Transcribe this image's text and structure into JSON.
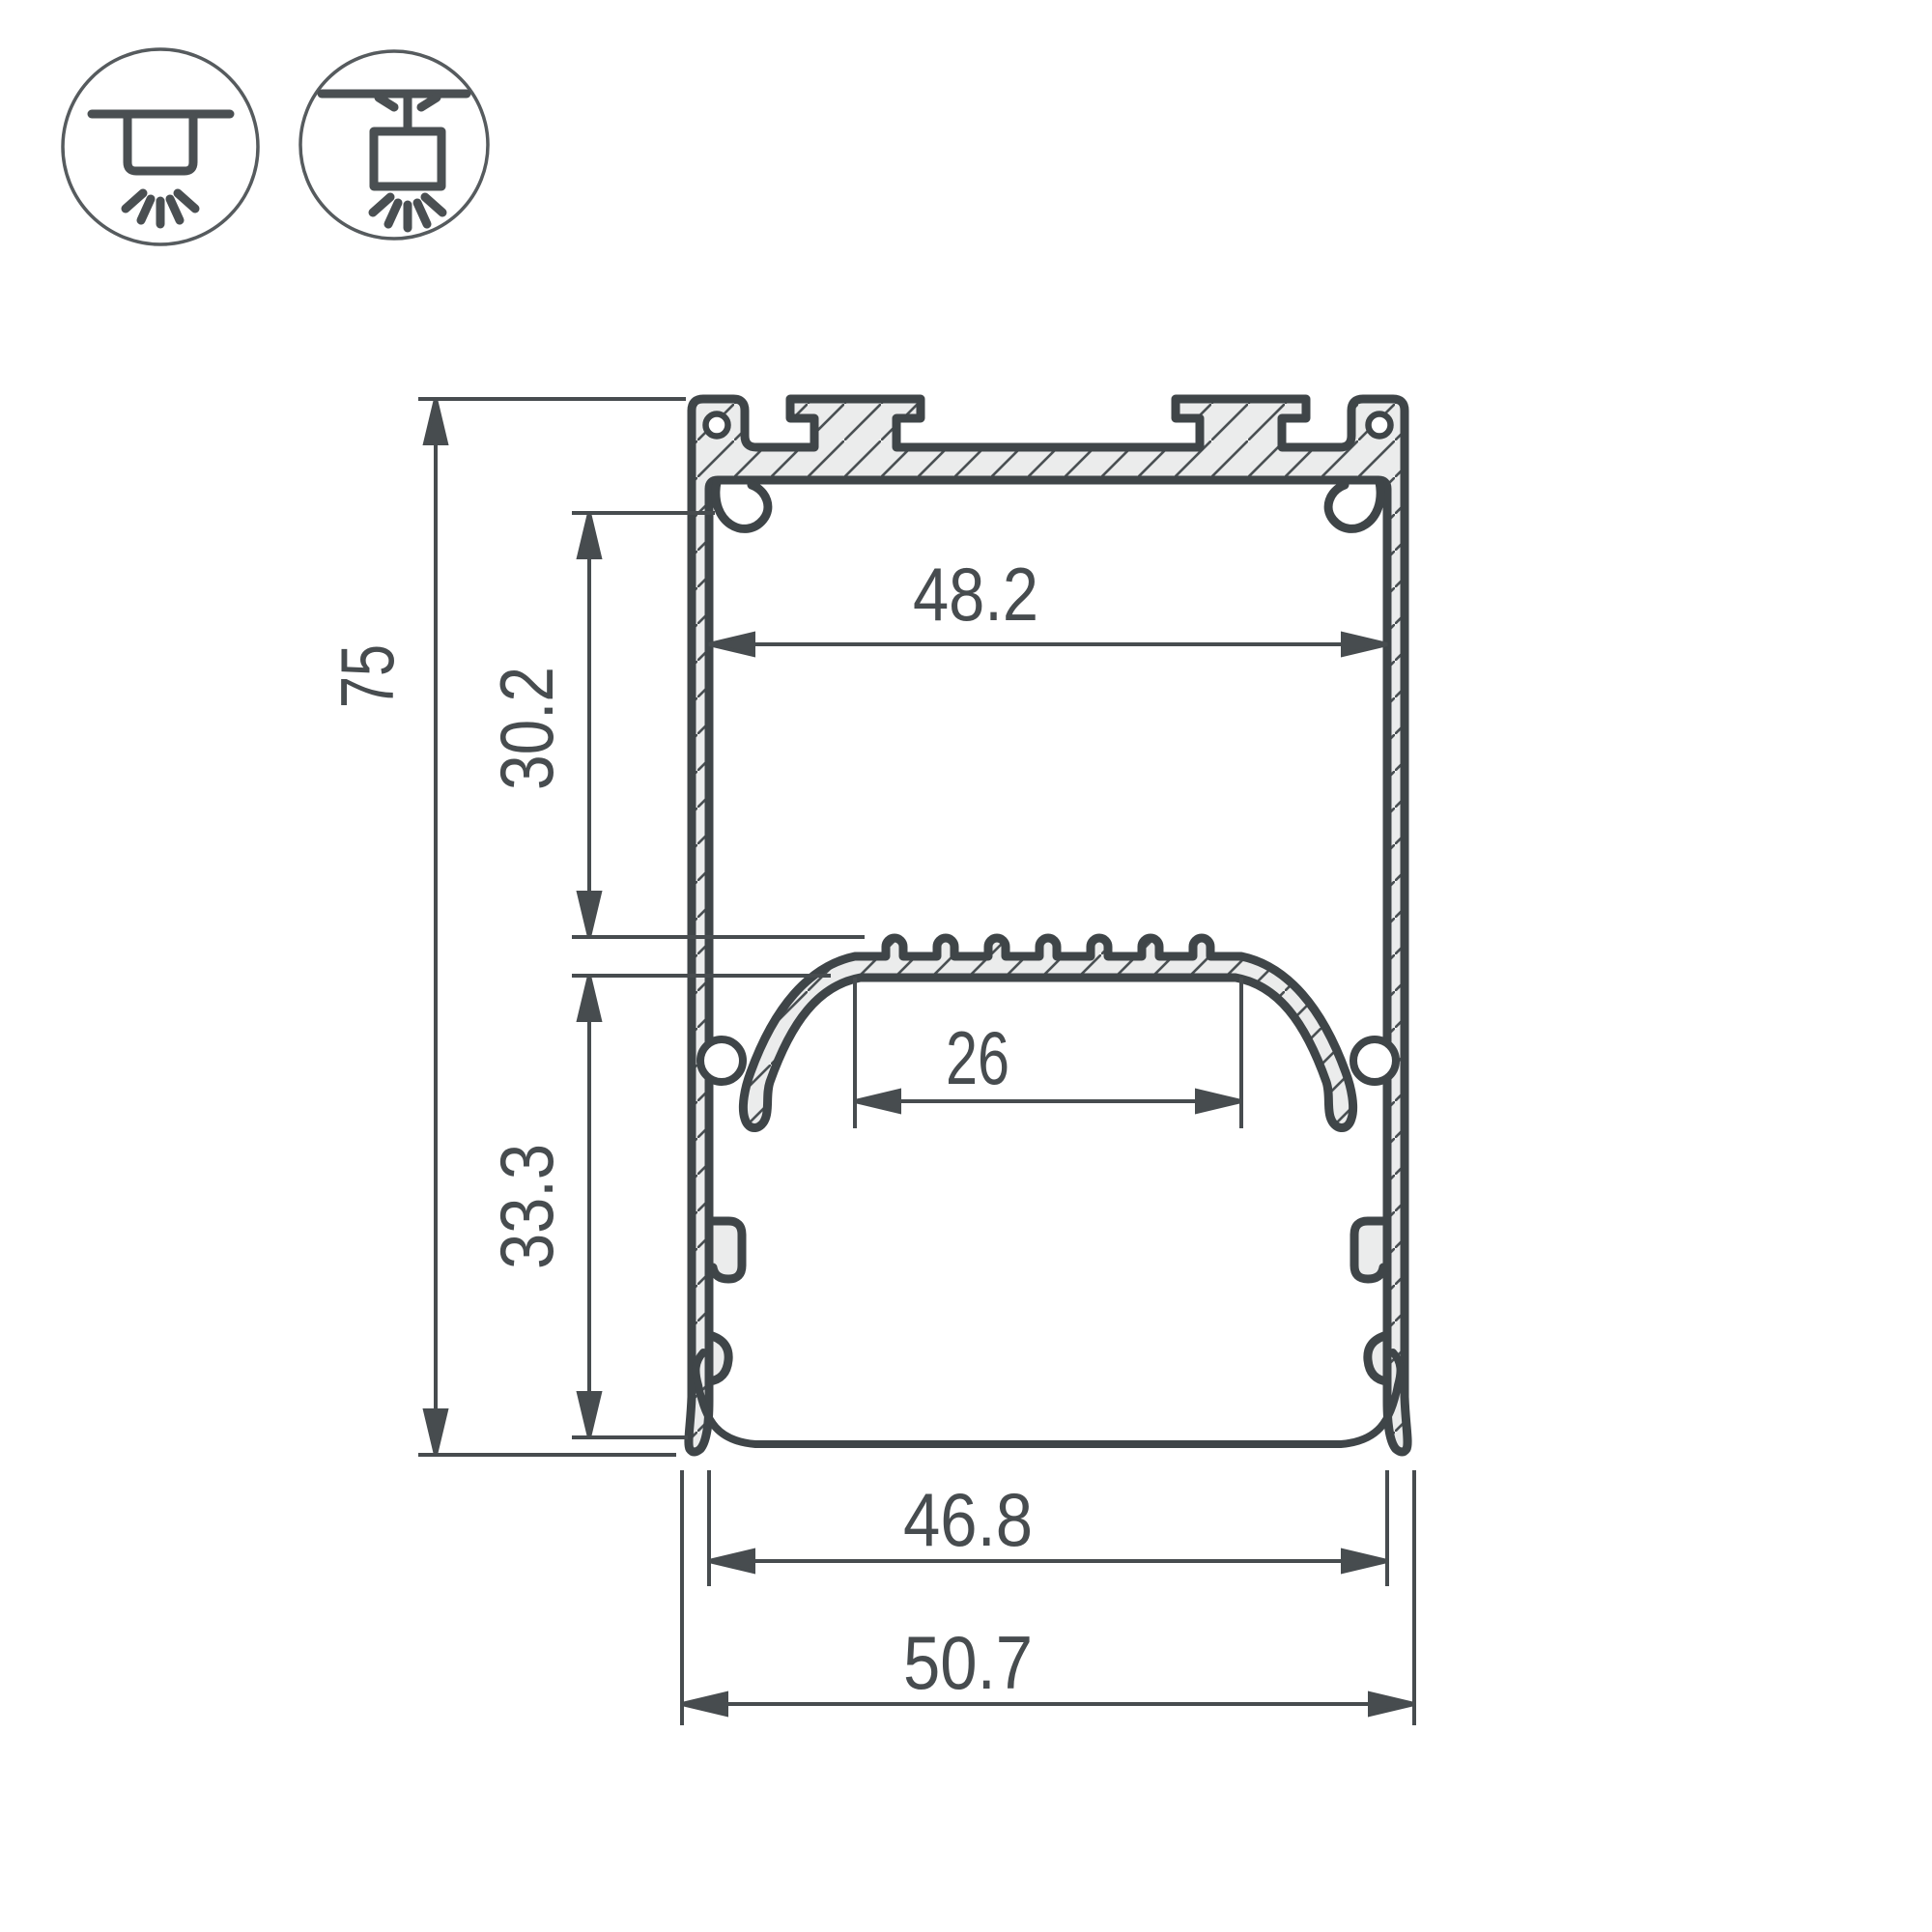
{
  "drawing": {
    "title": "led-profile-cross-section",
    "colors": {
      "outline": "#3f4548",
      "metal_fill": "#ebecec",
      "dimension_lines": "#474c4f",
      "text": "#474c4f",
      "background": "#ffffff",
      "icon_stroke": "#565b5e"
    },
    "mounting_icons": [
      {
        "name": "surface-mount-icon"
      },
      {
        "name": "suspended-mount-icon"
      }
    ],
    "dimensions": {
      "overall_height": "75",
      "upper_section_depth": "30.2",
      "lower_section_depth": "33.3",
      "inner_width_top": "48.2",
      "led_platform_width": "26",
      "inner_width_bottom": "46.8",
      "overall_width": "50.7"
    }
  }
}
